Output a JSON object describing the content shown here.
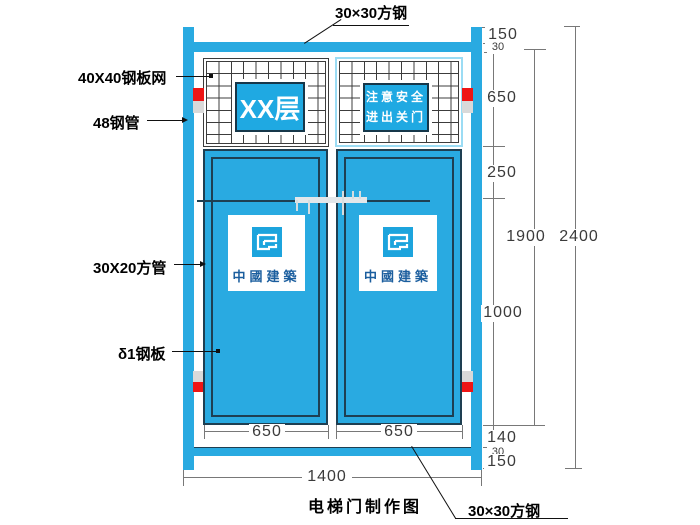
{
  "drawing": {
    "title": "电梯门制作图",
    "top_label": "30×30方钢",
    "bottom_label": "30×30方钢",
    "left_labels": [
      {
        "text": "40X40钢板网"
      },
      {
        "text": "48钢管"
      },
      {
        "text": "30X20方管"
      },
      {
        "text": "δ1钢板"
      }
    ],
    "signs": {
      "floor": "XX层",
      "safety_line1": "注意安全",
      "safety_line2": "进出关门",
      "company": "中國建築"
    },
    "dims_right": [
      "150",
      "30",
      "650",
      "250",
      "1000",
      "140",
      "30",
      "150"
    ],
    "dims_totals": [
      "1900",
      "2400"
    ],
    "dims_bottom": {
      "door_left": "650",
      "door_right": "650",
      "overall": "1400"
    },
    "colors": {
      "panel_blue": "#29aae1",
      "outline_dark": "#1e3f52",
      "accent_red": "#ee1515",
      "marker_gray": "#d9d9d9",
      "mesh_b_border": "#9bdcf4",
      "dim_gray": "#787878",
      "company_blue": "#1b5e9e"
    }
  }
}
